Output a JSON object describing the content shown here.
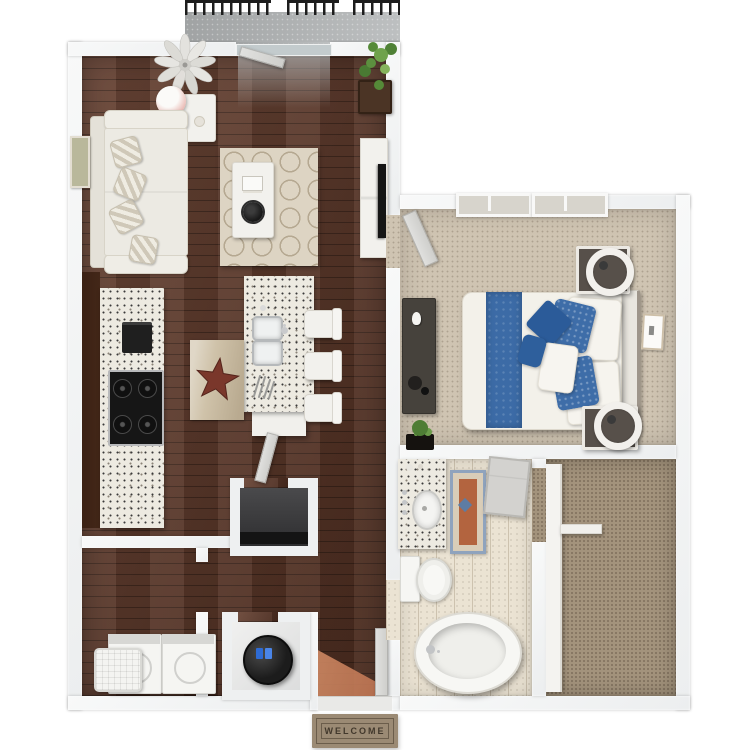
{
  "scene": {
    "type": "3d-floorplan-render",
    "background": "#ffffff"
  },
  "welcome_mat": {
    "text": "WELCOME"
  },
  "colors": {
    "wall": "#eceeef",
    "wood": "#5d3626",
    "carpet": "#cfc4b2",
    "closet_carpet": "#a3937c",
    "tile": "#ebe3d3",
    "concrete": "#b6b9ba",
    "granite": "#edeae1",
    "dark_cabinet": "#432718",
    "island_base": "#f1f0ec",
    "stainless": "#c9cacc",
    "appliance_black": "#161616",
    "sofa": "#eceae3",
    "rug": "#ddd4c3",
    "rug_line": "#b5a891",
    "bed_white": "#f3f1ea",
    "headboard": "#e9e6df",
    "bed_blue": "#3c6ba6",
    "pillow_navy": "#2b5b99",
    "terracotta": "#c07452",
    "mat_tan": "#9b8a74",
    "mat_border": "#6b5d4b",
    "mat_text": "#42382c",
    "star": "#7a372b",
    "plant": "#5c8f3f",
    "door": "#e0e0de",
    "railing": "#1d1d1d",
    "water_heater": "#1c1c1c",
    "heater_blue": "#2e6bd4",
    "dresser": "#46423c",
    "frame_gold": "#cdbfa8",
    "bath_rug_rust": "#b3643f",
    "bath_rug_blue": "#8fa3bd"
  },
  "rooms": {
    "balcony": {
      "items": [
        "railing",
        "concrete-floor",
        "sliding-glass-door"
      ]
    },
    "living_room": {
      "items": [
        "ceiling-fan",
        "side-table",
        "table-lamp",
        "sofa",
        "throw-pillows",
        "wall-art",
        "trellis-rug",
        "coffee-table",
        "books",
        "decor-bowl",
        "tv-console",
        "tv",
        "potted-plant"
      ]
    },
    "kitchen": {
      "items": [
        "cabinet-run",
        "granite-counter",
        "cooktop",
        "small-appliance",
        "island",
        "double-sink",
        "faucet",
        "utensils",
        "star-accent-mat",
        "bar-stool",
        "bar-stool",
        "bar-stool"
      ]
    },
    "hallway": {
      "items": [
        "coat-closet",
        "closet-door",
        "water-heater-closet",
        "water-heater"
      ]
    },
    "laundry": {
      "items": [
        "washer",
        "dryer",
        "laundry-basket"
      ]
    },
    "entry": {
      "items": [
        "front-door",
        "door-light-spill",
        "welcome-mat"
      ]
    },
    "bedroom": {
      "items": [
        "double-window",
        "bedroom-door",
        "dresser",
        "decor",
        "plant",
        "bed",
        "headboard",
        "blue-runner",
        "pillows",
        "nightstand",
        "nightstand",
        "ring-lamp",
        "ring-lamp",
        "wall-frame"
      ]
    },
    "bathroom": {
      "items": [
        "vanity",
        "sink",
        "faucet",
        "accent-rug",
        "cabinet",
        "toilet",
        "bathtub"
      ]
    },
    "walk_in_closet": {
      "items": [
        "carpet",
        "shelving",
        "shelf-bracket"
      ]
    }
  }
}
